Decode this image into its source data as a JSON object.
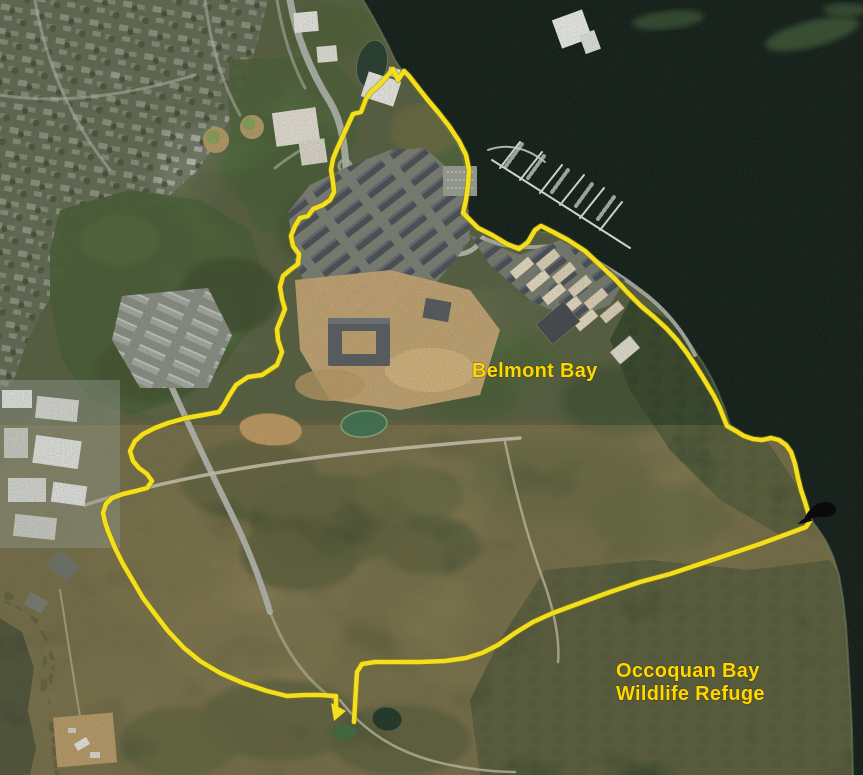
{
  "map": {
    "view": "satellite",
    "labels": {
      "belmont_bay": "Belmont Bay",
      "refuge_line1": "Occoquan Bay",
      "refuge_line2": "Wildlife Refuge"
    },
    "colors": {
      "track_yellow": "#f4df1d",
      "label_yellow": "#ffd800",
      "water": "#101c15",
      "marker_black": "#0a0a0a"
    },
    "track": {
      "points": [
        354,
        722,
        355,
        705,
        356,
        688,
        357,
        672,
        362,
        664,
        375,
        662,
        395,
        662,
        420,
        662,
        445,
        661,
        466,
        658,
        482,
        653,
        498,
        645,
        515,
        633,
        533,
        622,
        553,
        613,
        580,
        603,
        610,
        592,
        640,
        582,
        670,
        574,
        700,
        564,
        730,
        554,
        760,
        544,
        790,
        533,
        806,
        527,
        810,
        521,
        808,
        512,
        805,
        502,
        801,
        490,
        798,
        478,
        795,
        464,
        791,
        452,
        786,
        445,
        779,
        440,
        771,
        438,
        762,
        440,
        753,
        439,
        744,
        436,
        736,
        431,
        727,
        426,
        723,
        416,
        719,
        406,
        714,
        396,
        708,
        386,
        702,
        376,
        695,
        365,
        687,
        353,
        677,
        340,
        666,
        328,
        654,
        317,
        641,
        306,
        628,
        293,
        615,
        279,
        600,
        265,
        585,
        251,
        568,
        240,
        553,
        232,
        541,
        226,
        535,
        230,
        528,
        242,
        519,
        249,
        507,
        244,
        492,
        235,
        478,
        228,
        470,
        220,
        463,
        213,
        466,
        200,
        468,
        185,
        469,
        170,
        466,
        155,
        459,
        141,
        449,
        126,
        438,
        112,
        427,
        99,
        416,
        85,
        409,
        76,
        404,
        71,
        398,
        80,
        393,
        69,
        388,
        75,
        380,
        84,
        371,
        92,
        366,
        99,
        361,
        112,
        353,
        114,
        347,
        127,
        342,
        138,
        337,
        149,
        333,
        159,
        331,
        170,
        333,
        182,
        334,
        192,
        330,
        200,
        323,
        205,
        313,
        209,
        308,
        216,
        300,
        218,
        295,
        226,
        291,
        236,
        293,
        246,
        299,
        254,
        298,
        264,
        290,
        270,
        283,
        276,
        280,
        287,
        282,
        299,
        285,
        309,
        281,
        319,
        277,
        329,
        278,
        340,
        282,
        352,
        277,
        365,
        262,
        375,
        248,
        377,
        236,
        385,
        229,
        396,
        224,
        405,
        219,
        412,
        203,
        415,
        186,
        418,
        168,
        423,
        155,
        428,
        143,
        434,
        135,
        441,
        130,
        451,
        133,
        461,
        139,
        468,
        147,
        474,
        152,
        481,
        147,
        488,
        136,
        491,
        123,
        494,
        112,
        498,
        106,
        504,
        103,
        513,
        105,
        522,
        108,
        531,
        115,
        548,
        123,
        564,
        133,
        581,
        143,
        598,
        155,
        614,
        168,
        631,
        184,
        648,
        200,
        661,
        220,
        673,
        243,
        683,
        267,
        691,
        287,
        696,
        305,
        695,
        320,
        695,
        336,
        696,
        336,
        706
      ],
      "end_arrow_points": "331,703 346,711 334,721"
    }
  }
}
